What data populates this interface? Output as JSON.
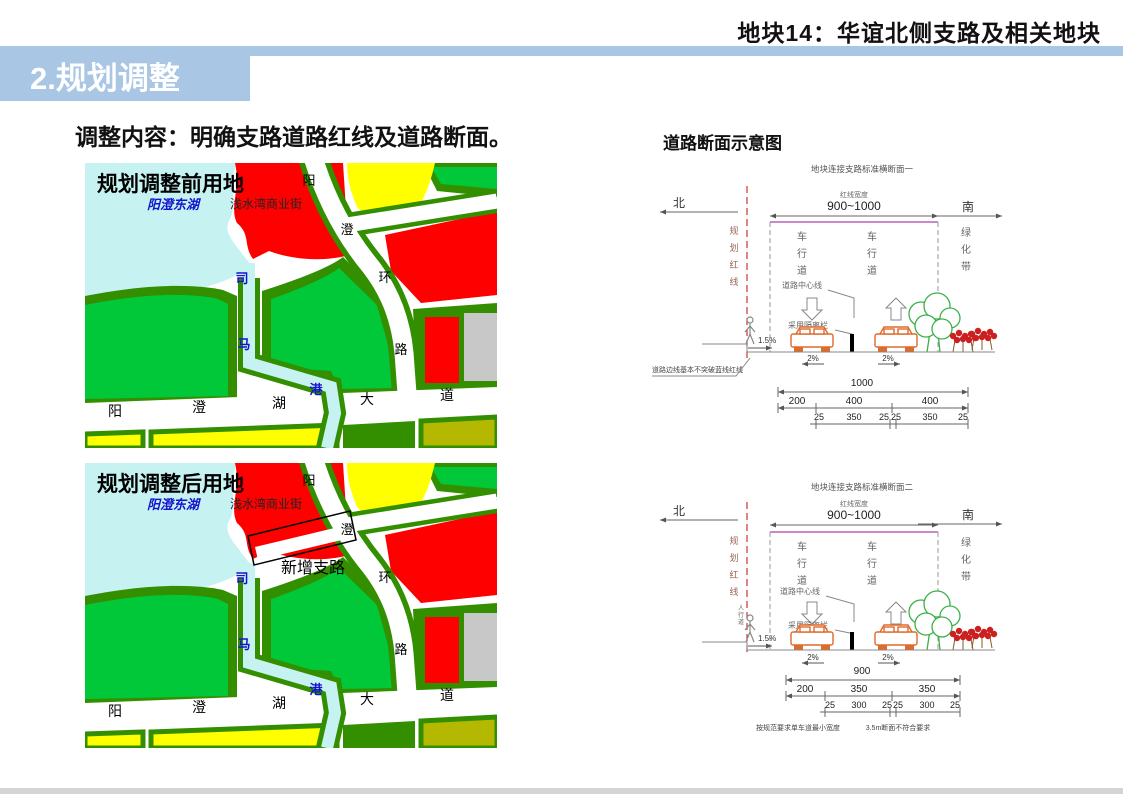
{
  "header": {
    "plot_title": "地块14：华谊北侧支路及相关地块"
  },
  "section": {
    "number_title": "2.规划调整"
  },
  "content": {
    "subtitle": "调整内容：明确支路道路红线及道路断面。"
  },
  "maps": {
    "before": {
      "title": "规划调整前用地",
      "lake": "阳澄东湖",
      "commercial": "浅水湾商业街",
      "river": "司马港",
      "ring_road": "阳澄环路",
      "avenue": "阳澄湖大道"
    },
    "after": {
      "title": "规划调整后用地",
      "lake": "阳澄东湖",
      "commercial": "浅水湾商业街",
      "river": "司马港",
      "ring_road": "阳澄环路",
      "avenue": "阳澄湖大道",
      "new_road": "新增支路"
    }
  },
  "cross_sections": {
    "heading": "道路断面示意图",
    "d1": {
      "title": "地块连接支路标准横断面一",
      "north": "北",
      "south": "南",
      "redline": "规划红线",
      "width_label": "红线宽度",
      "width_value": "900~1000",
      "lane_left": "车行道",
      "lane_right": "车行道",
      "green_belt": "绿化带",
      "centerline": "道路中心线",
      "barrier": "采用隔离栏",
      "sidewalk_slope": "1.5%",
      "lane_slope_left": "2%",
      "lane_slope_right": "2%",
      "note": "道路边线基本不突破蓝线红线",
      "dim_total": "1000",
      "dim_row1": [
        "200",
        "400",
        "400"
      ],
      "dim_row2": [
        "25",
        "350",
        "25",
        "25",
        "350",
        "25"
      ]
    },
    "d2": {
      "title": "地块连接支路标准横断面二",
      "north": "北",
      "south": "南",
      "redline": "规划红线",
      "width_label": "红线宽度",
      "width_value": "900~1000",
      "lane_left": "车行道",
      "lane_right": "车行道",
      "green_belt": "绿化带",
      "centerline": "道路中心线",
      "barrier": "采用隔离栏",
      "sidewalk": "人行道",
      "sidewalk_slope": "1.5%",
      "lane_slope_left": "2%",
      "lane_slope_right": "2%",
      "note_left": "按规范要求单车道最小宽度",
      "note_right": "3.5m断面不符合要求",
      "dim_total": "900",
      "dim_row1": [
        "200",
        "350",
        "350"
      ],
      "dim_row2": [
        "25",
        "300",
        "25",
        "25",
        "300",
        "25"
      ]
    }
  },
  "colors": {
    "accent_blue": "#a9c6e5",
    "map_bright_green": "#00c838",
    "map_dark_green": "#338f00",
    "map_lake_cyan": "#c6f2f2",
    "map_red": "#fe0000",
    "map_yellow": "#ffff00",
    "map_gray": "#c8c8c8",
    "map_olive": "#b5b800",
    "diagram_magenta": "#cc88cc",
    "diagram_redline": "#cc3333",
    "car_orange": "#e06a2a",
    "tree_green": "#3cb048",
    "shrub_red": "#cc2020"
  }
}
